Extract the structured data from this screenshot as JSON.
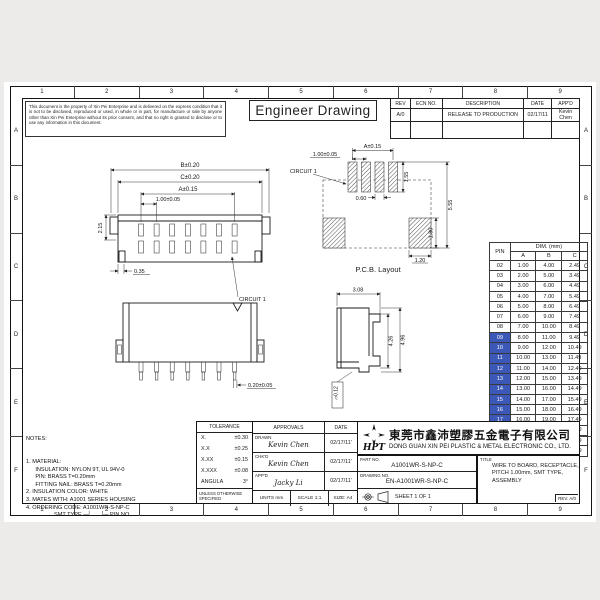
{
  "page": {
    "accent_blue": "#3b57b8",
    "paper": "#ffffff",
    "line": "#141414"
  },
  "frame": {
    "columns": [
      "1",
      "2",
      "3",
      "4",
      "5",
      "6",
      "7",
      "8",
      "9"
    ],
    "rows_letters": [
      "A",
      "B",
      "C",
      "D",
      "E",
      "F"
    ]
  },
  "disclaimer": "This document is the property of Xin Pei Enterprise and is delivered on the express condition that it is not to be disclosed, reproduced or used, in whole or in part, for manufacture or sale by anyone other than Xin Pei Enterprise without its prior consent, and that no right is granted to disclose or to use any information in this document.",
  "drawing_title": "Engineer Drawing",
  "rev_table": {
    "headers": [
      "REV",
      "ECN NO.",
      "DESCRIPTION",
      "DATE",
      "APP'D"
    ],
    "rows": [
      {
        "rev": "A/0",
        "ecn": "",
        "description": "RELEASE TO PRODUCTION",
        "date": "02/17/11",
        "approved": "Kevin Chen"
      }
    ]
  },
  "front_view": {
    "dim_b": "B±0.20",
    "dim_c": "C±0.20",
    "dim_a": "A±0.15",
    "dim_pitch": "1.00±0.05",
    "dim_height": "2.15",
    "dim_offset": "0.35",
    "circuit_label": "CIRCUIT 1"
  },
  "pcb_view": {
    "caption": "P.C.B. Layout",
    "dim_a": "A±0.15",
    "dim_pitch": "1.00±0.05",
    "dim_pad_h": "1.55",
    "dim_pad_w": "0.60",
    "dim_span": "5.55",
    "dim_nail_h": "1.80",
    "dim_nail_w": "1.20",
    "circuit_label": "CIRCUIT 1"
  },
  "side_view": {
    "dim_w": "3.08",
    "dim_h1": "4.26",
    "dim_h2": "4.96",
    "flatness": "▱0.12"
  },
  "bottom_view": {
    "dim_pad": "0.20±0.05"
  },
  "pin_table": {
    "col_pin": "PIN",
    "col_dim": "DIM. (mm)",
    "sub_cols": [
      "A",
      "B",
      "C"
    ],
    "rows": [
      [
        "02",
        "1.00",
        "4.00",
        "2.49"
      ],
      [
        "03",
        "2.00",
        "5.00",
        "3.49"
      ],
      [
        "04",
        "3.00",
        "6.00",
        "4.49"
      ],
      [
        "05",
        "4.00",
        "7.00",
        "5.49"
      ],
      [
        "06",
        "5.00",
        "8.00",
        "6.49"
      ],
      [
        "07",
        "6.00",
        "9.00",
        "7.49"
      ],
      [
        "08",
        "7.00",
        "10.00",
        "8.49"
      ],
      [
        "09",
        "8.00",
        "11.00",
        "9.49"
      ],
      [
        "10",
        "9.00",
        "12.00",
        "10.49"
      ],
      [
        "11",
        "10.00",
        "13.00",
        "11.49"
      ],
      [
        "12",
        "11.00",
        "14.00",
        "12.49"
      ],
      [
        "13",
        "12.00",
        "15.00",
        "13.49"
      ],
      [
        "14",
        "13.00",
        "16.00",
        "14.49"
      ],
      [
        "15",
        "14.00",
        "17.00",
        "15.49"
      ],
      [
        "16",
        "15.00",
        "18.00",
        "16.49"
      ],
      [
        "17",
        "16.00",
        "19.00",
        "17.49"
      ],
      [
        "18",
        "17.00",
        "20.00",
        "18.49"
      ],
      [
        "19",
        "18.00",
        "21.00",
        "19.49"
      ],
      [
        "20",
        "19.00",
        "22.00",
        "20.49"
      ]
    ],
    "highlighted_pins": [
      "09",
      "10",
      "11",
      "12",
      "13",
      "14",
      "15",
      "16",
      "17",
      "18",
      "19",
      "20"
    ]
  },
  "notes": {
    "heading": "NOTES:",
    "lines": [
      "1. MATERIAL:",
      "      INSULATION: NYLON 9T, UL 94V-0",
      "      PIN: BRASS T=0.20mm",
      "      FITTING NAIL: BRASS T=0.20mm",
      "2. INSULATION COLOR: WHITE",
      "3. MATES WITH: A1001 SERIES HOUSING",
      "4. ORDERING CODE: A1001WR-S-NP-C",
      "                  SMT TYPE ─┘      └─ PIN NO."
    ]
  },
  "tolerance": {
    "heading": "TOLERANCE",
    "rows": [
      [
        "X.",
        "±0.30"
      ],
      [
        "X.X",
        "±0.25"
      ],
      [
        "X.XX",
        "±0.15"
      ],
      [
        "X.XXX",
        "±0.08"
      ],
      [
        "ANGULA",
        "3°"
      ]
    ],
    "footnote": "UNLESS OTHERWISE SPECIFIED"
  },
  "approvals": {
    "heading": "APPROVALS",
    "date_heading": "DATE",
    "rows": [
      {
        "role": "DRAWN",
        "name": "Kevin Chen",
        "date": "02/17/11'"
      },
      {
        "role": "CHK'D",
        "name": "Kevin Chen",
        "date": "02/17/11'"
      },
      {
        "role": "APP'D",
        "name": "Jacky Li",
        "date": "02/17/11'"
      }
    ],
    "units_label": "UNITS  mm",
    "scale_label": "SCALE  1:1",
    "size_label": "SIZE: A4"
  },
  "title_block": {
    "logo_text": "HPT",
    "company_cn": "東莞市鑫沛塑膠五金電子有限公司",
    "company_en": "DONG GUAN XIN PEI PLASTIC & METAL ELECTRONIC CO., LTD.",
    "part_no_label": "PART NO.",
    "part_no": "A1001WR-S-NP-C",
    "drawing_no_label": "DRAWING NO.",
    "drawing_no": "EN-A1001WR-S-NP-C",
    "sheet_label": "SHEET   1   OF   1",
    "title_label": "TITLE",
    "title_lines": [
      "WIRE TO BOARD, RECEPTACLE,",
      "PITCH 1.00mm, SMT TYPE,",
      "ASSEMBLY"
    ],
    "rev_label": "REV. A/0"
  }
}
